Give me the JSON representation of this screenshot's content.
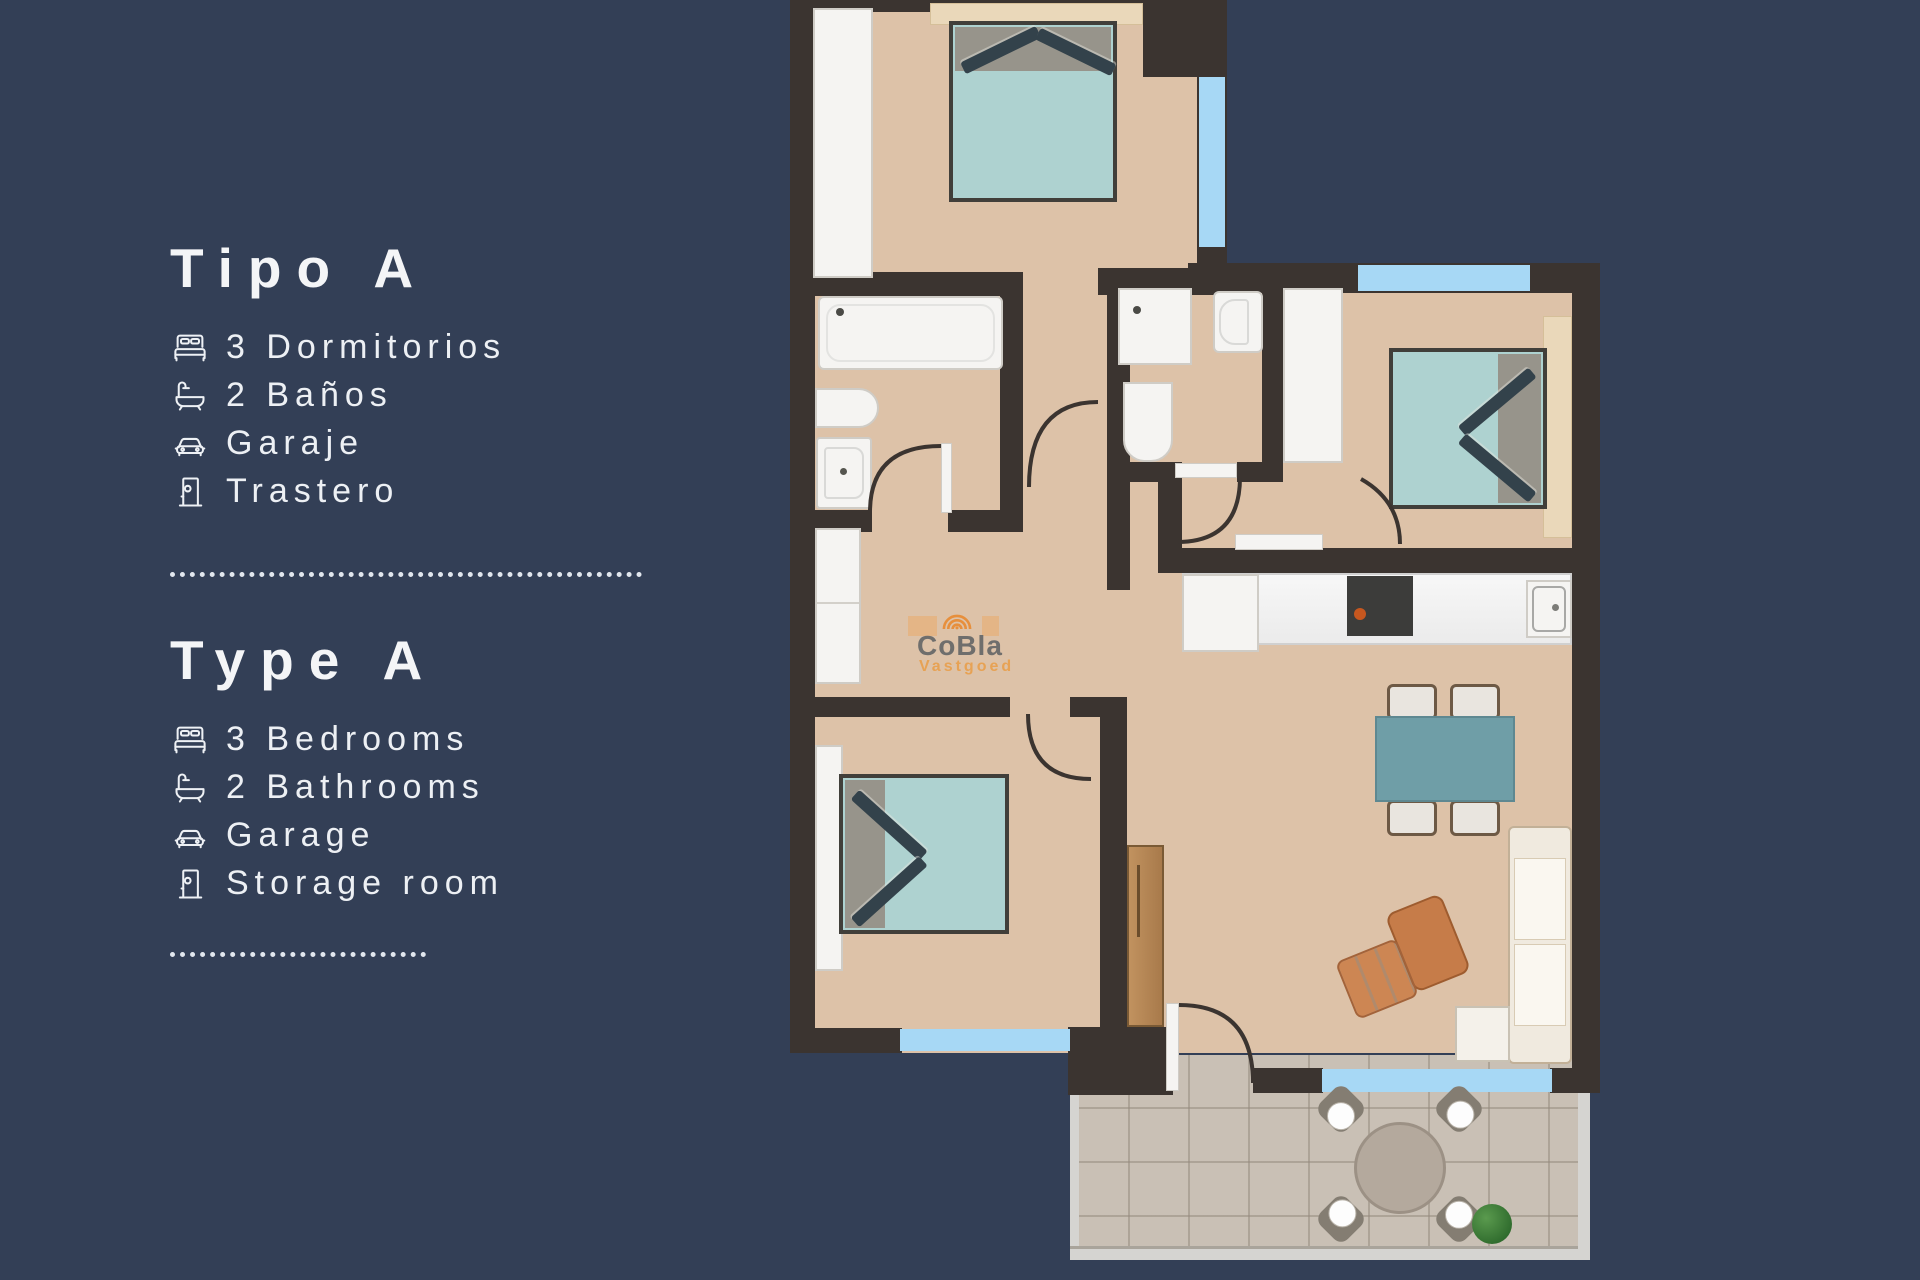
{
  "panel_es": {
    "title": "Tipo A",
    "items": [
      {
        "icon": "bed-icon",
        "label": "3 Dormitorios"
      },
      {
        "icon": "bathtub-icon",
        "label": "2 Baños"
      },
      {
        "icon": "car-icon",
        "label": "Garaje"
      },
      {
        "icon": "door-icon",
        "label": "Trastero"
      }
    ]
  },
  "panel_en": {
    "title": "Type A",
    "items": [
      {
        "icon": "bed-icon",
        "label": "3 Bedrooms"
      },
      {
        "icon": "bathtub-icon",
        "label": "2 Bathrooms"
      },
      {
        "icon": "car-icon",
        "label": "Garage"
      },
      {
        "icon": "door-icon",
        "label": "Storage room"
      }
    ]
  },
  "watermark": {
    "icon": "arcs-logo",
    "line1": "CoBla",
    "line2": "Vastgoed"
  },
  "colors": {
    "background": "#333f56",
    "text": "#eef1f5",
    "wall": "#3b3430",
    "floor": "#ddc2a8",
    "terrace_floor": "#c9c0b5",
    "window_blue": "#a7d8f5",
    "bed_teal": "#aed2d0",
    "dining_teal": "#6f9ea7",
    "armchair_terracotta": "#c67c49",
    "wood_door": "#b9895a",
    "watermark_gray": "#6f6e6c",
    "watermark_orange": "#e7a254"
  }
}
